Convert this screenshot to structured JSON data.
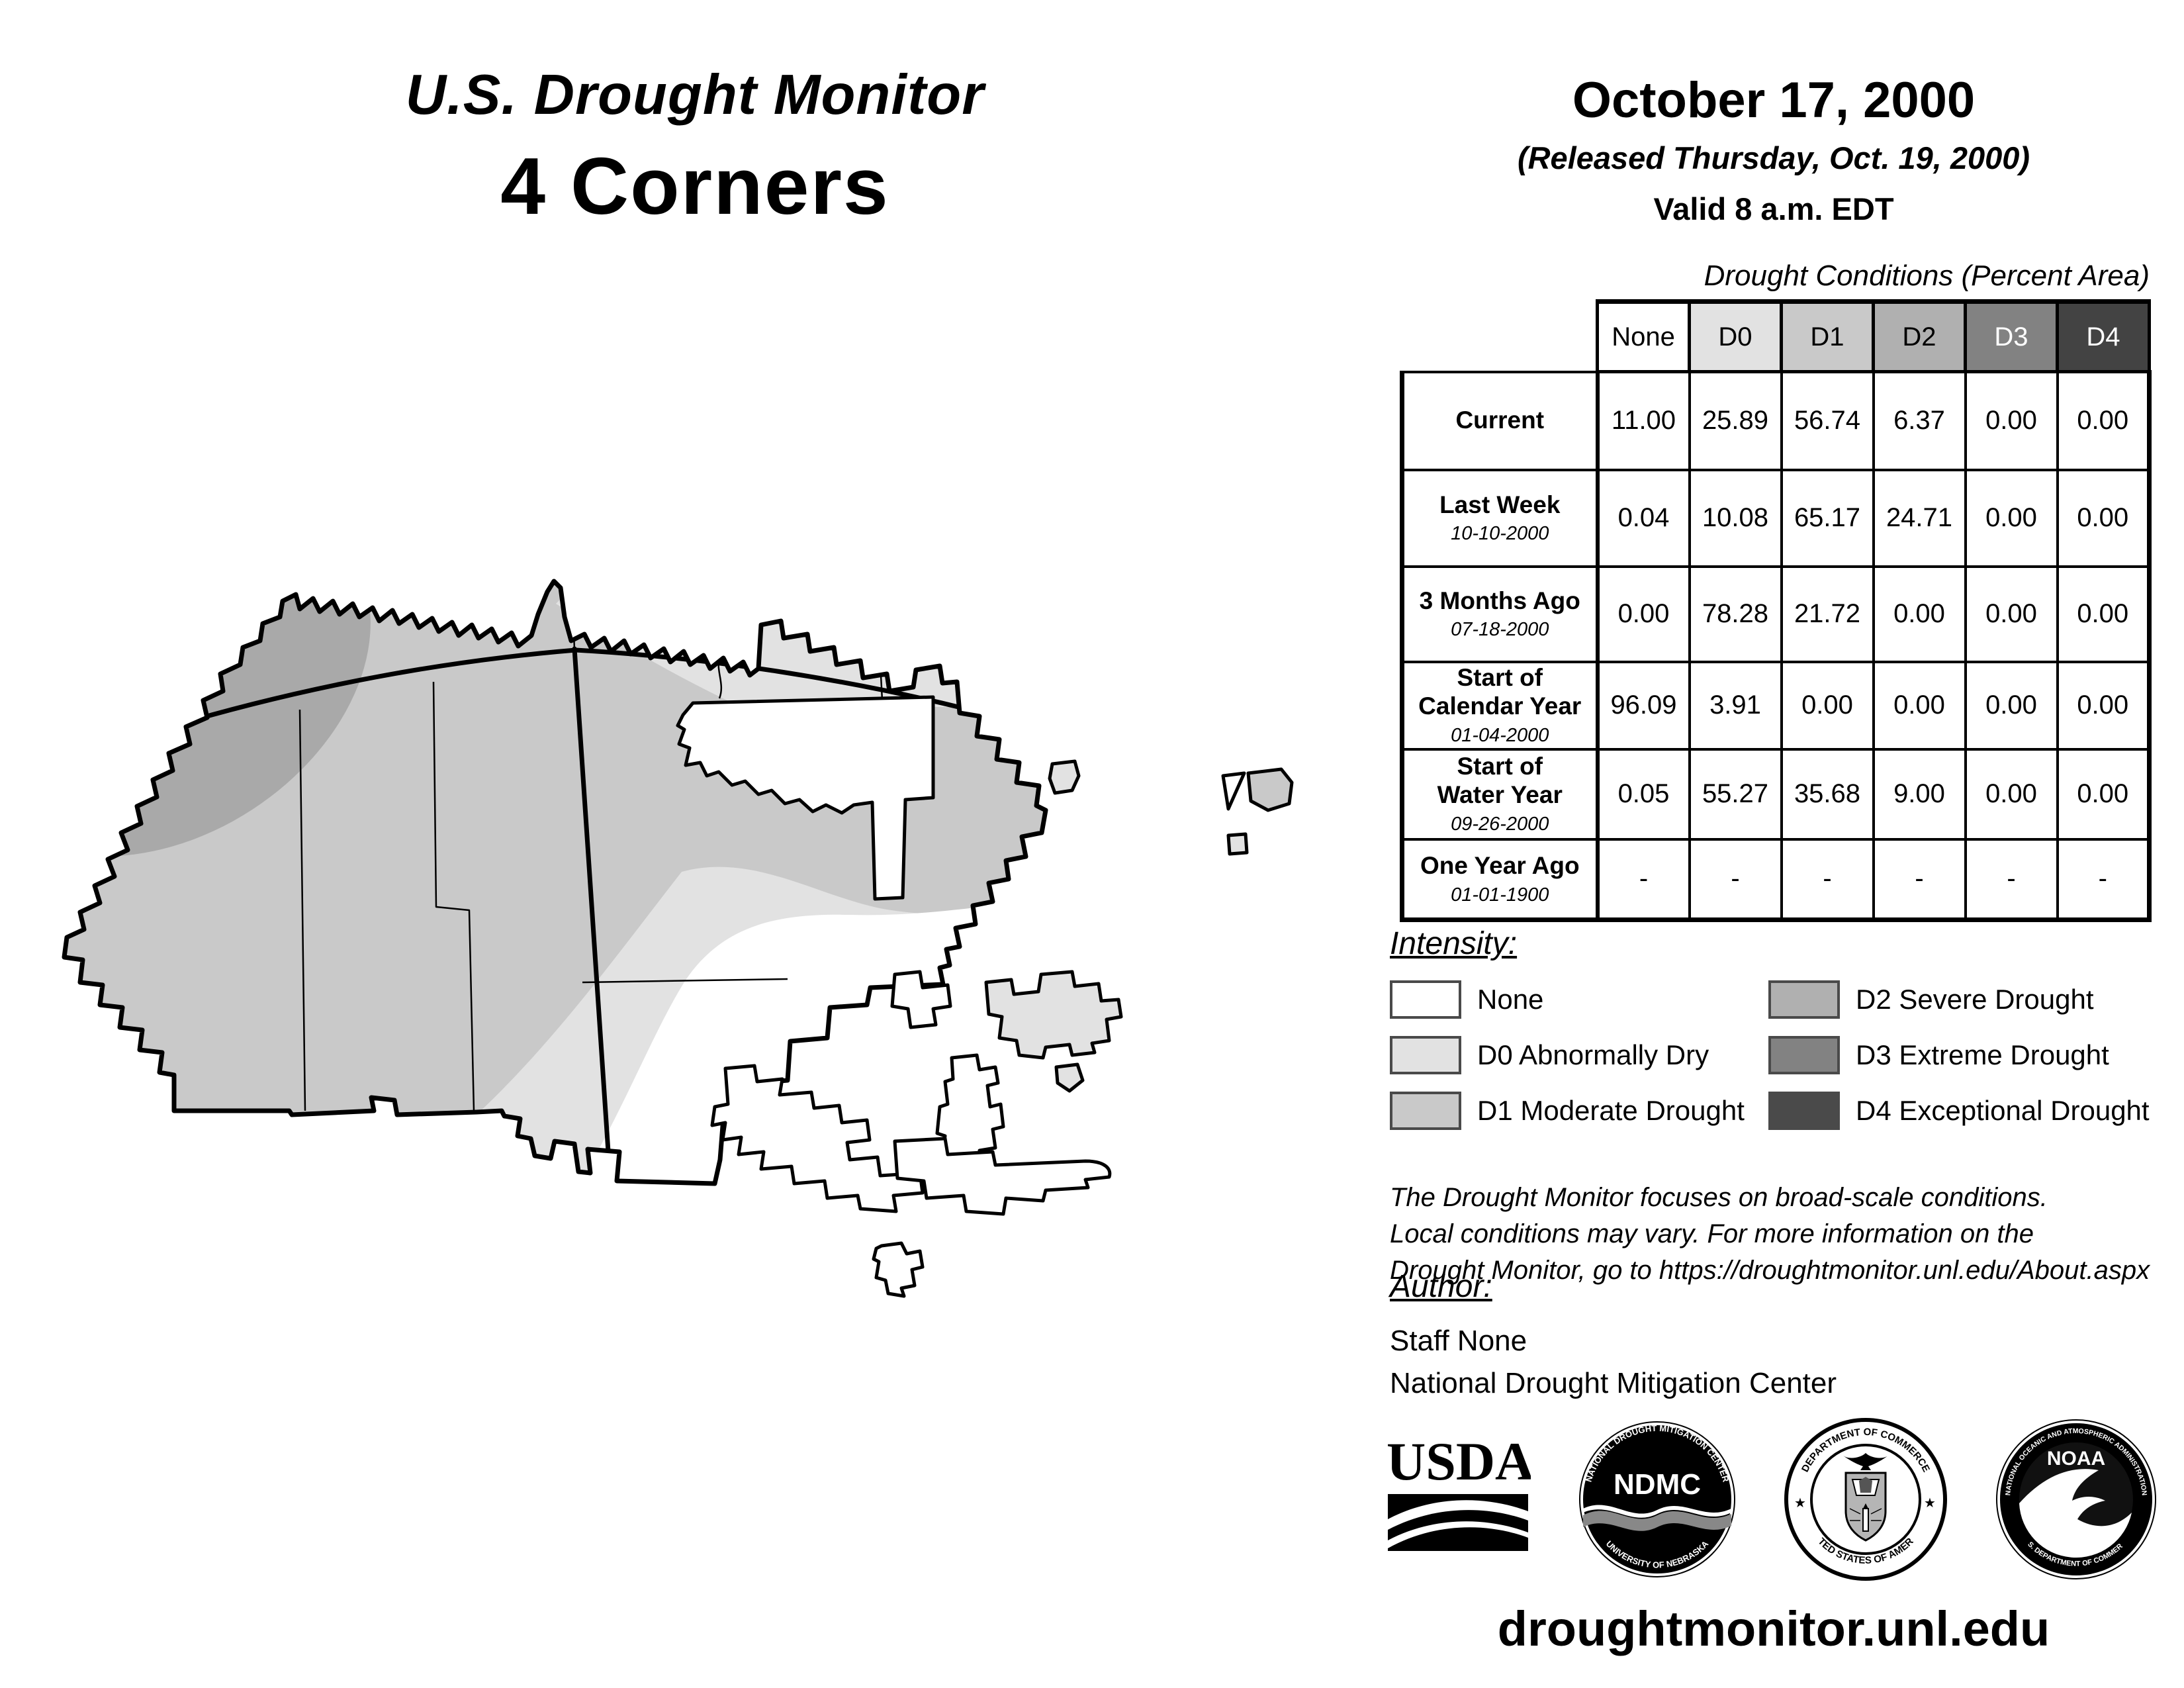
{
  "header": {
    "title": "U.S. Drought Monitor",
    "region": "4 Corners",
    "date": "October 17, 2000",
    "released": "(Released Thursday, Oct. 19, 2000)",
    "valid": "Valid 8 a.m. EDT"
  },
  "table": {
    "caption": "Drought Conditions (Percent Area)",
    "columns": [
      "None",
      "D0",
      "D1",
      "D2",
      "D3",
      "D4"
    ],
    "column_colors": [
      "#ffffff",
      "#e2e2e2",
      "#c9c9c9",
      "#b0b0b0",
      "#828282",
      "#434343"
    ],
    "column_text_colors": [
      "#000000",
      "#000000",
      "#000000",
      "#000000",
      "#ffffff",
      "#ffffff"
    ],
    "rows": [
      {
        "label": "Current",
        "sublabel": "",
        "values": [
          "11.00",
          "25.89",
          "56.74",
          "6.37",
          "0.00",
          "0.00"
        ]
      },
      {
        "label": "Last Week",
        "sublabel": "10-10-2000",
        "values": [
          "0.04",
          "10.08",
          "65.17",
          "24.71",
          "0.00",
          "0.00"
        ]
      },
      {
        "label": "3 Months Ago",
        "sublabel": "07-18-2000",
        "values": [
          "0.00",
          "78.28",
          "21.72",
          "0.00",
          "0.00",
          "0.00"
        ]
      },
      {
        "label": "Start of\nCalendar Year",
        "sublabel": "01-04-2000",
        "values": [
          "96.09",
          "3.91",
          "0.00",
          "0.00",
          "0.00",
          "0.00"
        ]
      },
      {
        "label": "Start of\nWater Year",
        "sublabel": "09-26-2000",
        "values": [
          "0.05",
          "55.27",
          "35.68",
          "9.00",
          "0.00",
          "0.00"
        ]
      },
      {
        "label": "One Year Ago",
        "sublabel": "01-01-1900",
        "values": [
          "-",
          "-",
          "-",
          "-",
          "-",
          "-"
        ]
      }
    ]
  },
  "legend": {
    "heading": "Intensity:",
    "items": [
      {
        "label": "None",
        "color": "#ffffff"
      },
      {
        "label": "D0 Abnormally Dry",
        "color": "#e2e2e2"
      },
      {
        "label": "D1 Moderate Drought",
        "color": "#c9c9c9"
      },
      {
        "label": "D2 Severe Drought",
        "color": "#b0b0b0"
      },
      {
        "label": "D3 Extreme Drought",
        "color": "#828282"
      },
      {
        "label": "D4 Exceptional Drought",
        "color": "#4a4a4a"
      }
    ]
  },
  "disclaimer": "The Drought Monitor focuses on broad-scale conditions.\nLocal conditions may vary. For more information on the\nDrought Monitor, go to https://droughtmonitor.unl.edu/About.aspx",
  "author": {
    "heading": "Author:",
    "name": "Staff None",
    "org": "National Drought Mitigation Center"
  },
  "logos": {
    "usda": {
      "label": "USDA"
    },
    "ndmc": {
      "center": "NDMC",
      "ring_top": "NATIONAL DROUGHT MITIGATION CENTER",
      "ring_bottom": "UNIVERSITY OF NEBRASKA"
    },
    "doc": {
      "ring_top": "DEPARTMENT OF COMMERCE",
      "ring_bottom": "UNITED STATES OF AMERICA"
    },
    "noaa": {
      "center": "NOAA",
      "ring_top": "NATIONAL OCEANIC AND ATMOSPHERIC ADMINISTRATION",
      "ring_bottom": "U.S. DEPARTMENT OF COMMERCE"
    }
  },
  "footer": {
    "url": "droughtmonitor.unl.edu"
  },
  "map": {
    "palette": {
      "none": "#ffffff",
      "d0": "#e2e2e2",
      "d1": "#c9c9c9",
      "d2": "#a9a9a9"
    }
  }
}
